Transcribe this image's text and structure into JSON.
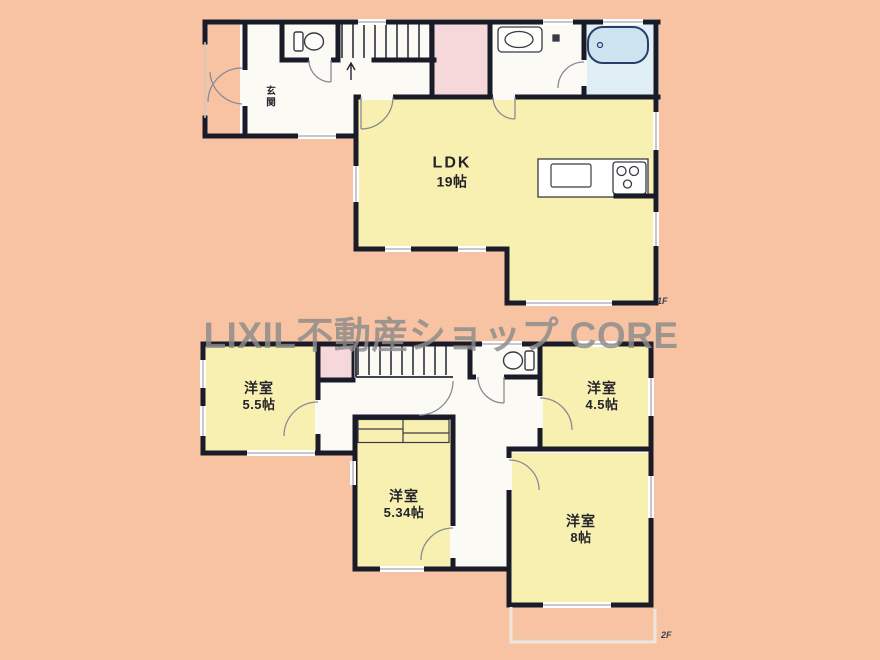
{
  "watermark": "LIXIL不動産ショップ CORE",
  "floor_1": {
    "tag": "1F",
    "entrance_label": "玄関",
    "ldk": {
      "name": "LDK",
      "size": "19帖"
    }
  },
  "floor_2": {
    "tag": "2F",
    "room_5_5": {
      "name": "洋室",
      "size": "5.5帖"
    },
    "room_4_5": {
      "name": "洋室",
      "size": "4.5帖"
    },
    "room_5_34": {
      "name": "洋室",
      "size": "5.34帖"
    },
    "room_8": {
      "name": "洋室",
      "size": "8帖"
    }
  },
  "colors": {
    "background": "#f8c3a2",
    "room_yellow": "#f8f0b0",
    "room_pink": "#f6d8da",
    "bath_blue": "#e0eef5",
    "tub_blue": "#cde3ef",
    "wall": "#1a1b28",
    "watermark_gray": "#8c8c8c"
  }
}
